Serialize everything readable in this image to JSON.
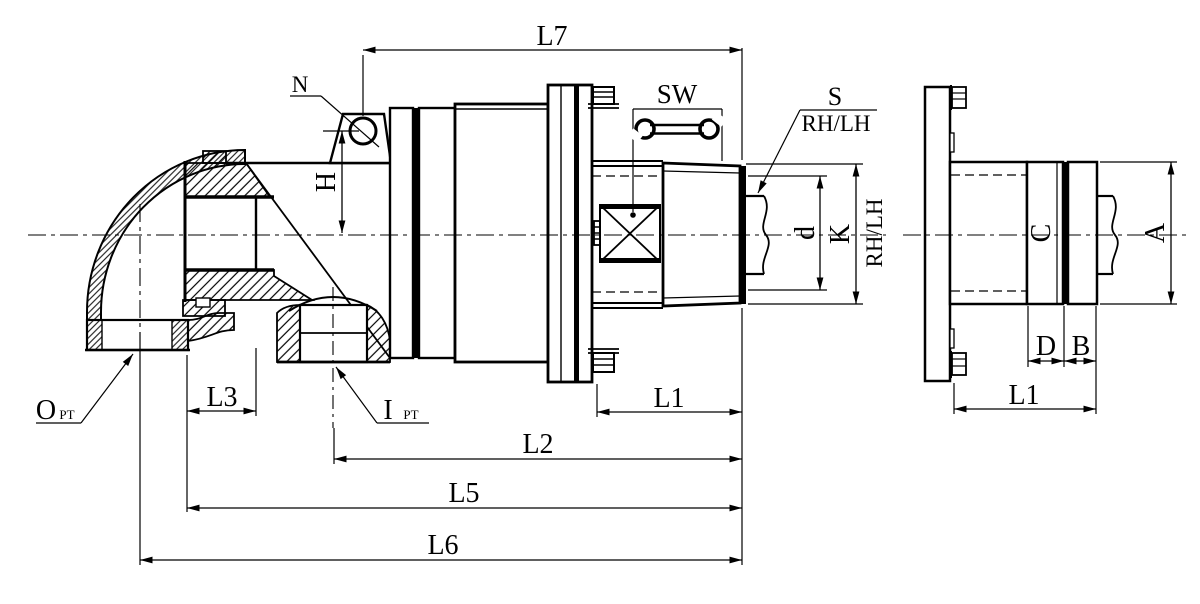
{
  "drawing": {
    "kind": "rotary-joint-dimension-drawing",
    "colors": {
      "line": "#000000",
      "background": "#ffffff"
    },
    "main_view": {
      "labels": {
        "eyebolt": "N",
        "l7": "L7",
        "wrench_size": "SW",
        "thread": "S",
        "thread_hand": "RH/LH",
        "h": "H",
        "d": "d",
        "k": "K",
        "rotation_hand": "RH/LH",
        "outlet": "O",
        "outlet_sub": "PT",
        "inlet": "I",
        "inlet_sub": "PT",
        "l1": "L1",
        "l2": "L2",
        "l3": "L3",
        "l5": "L5",
        "l6": "L6"
      }
    },
    "side_view": {
      "labels": {
        "a": "A",
        "b": "B",
        "c": "C",
        "d": "D",
        "l1": "L1"
      }
    }
  }
}
